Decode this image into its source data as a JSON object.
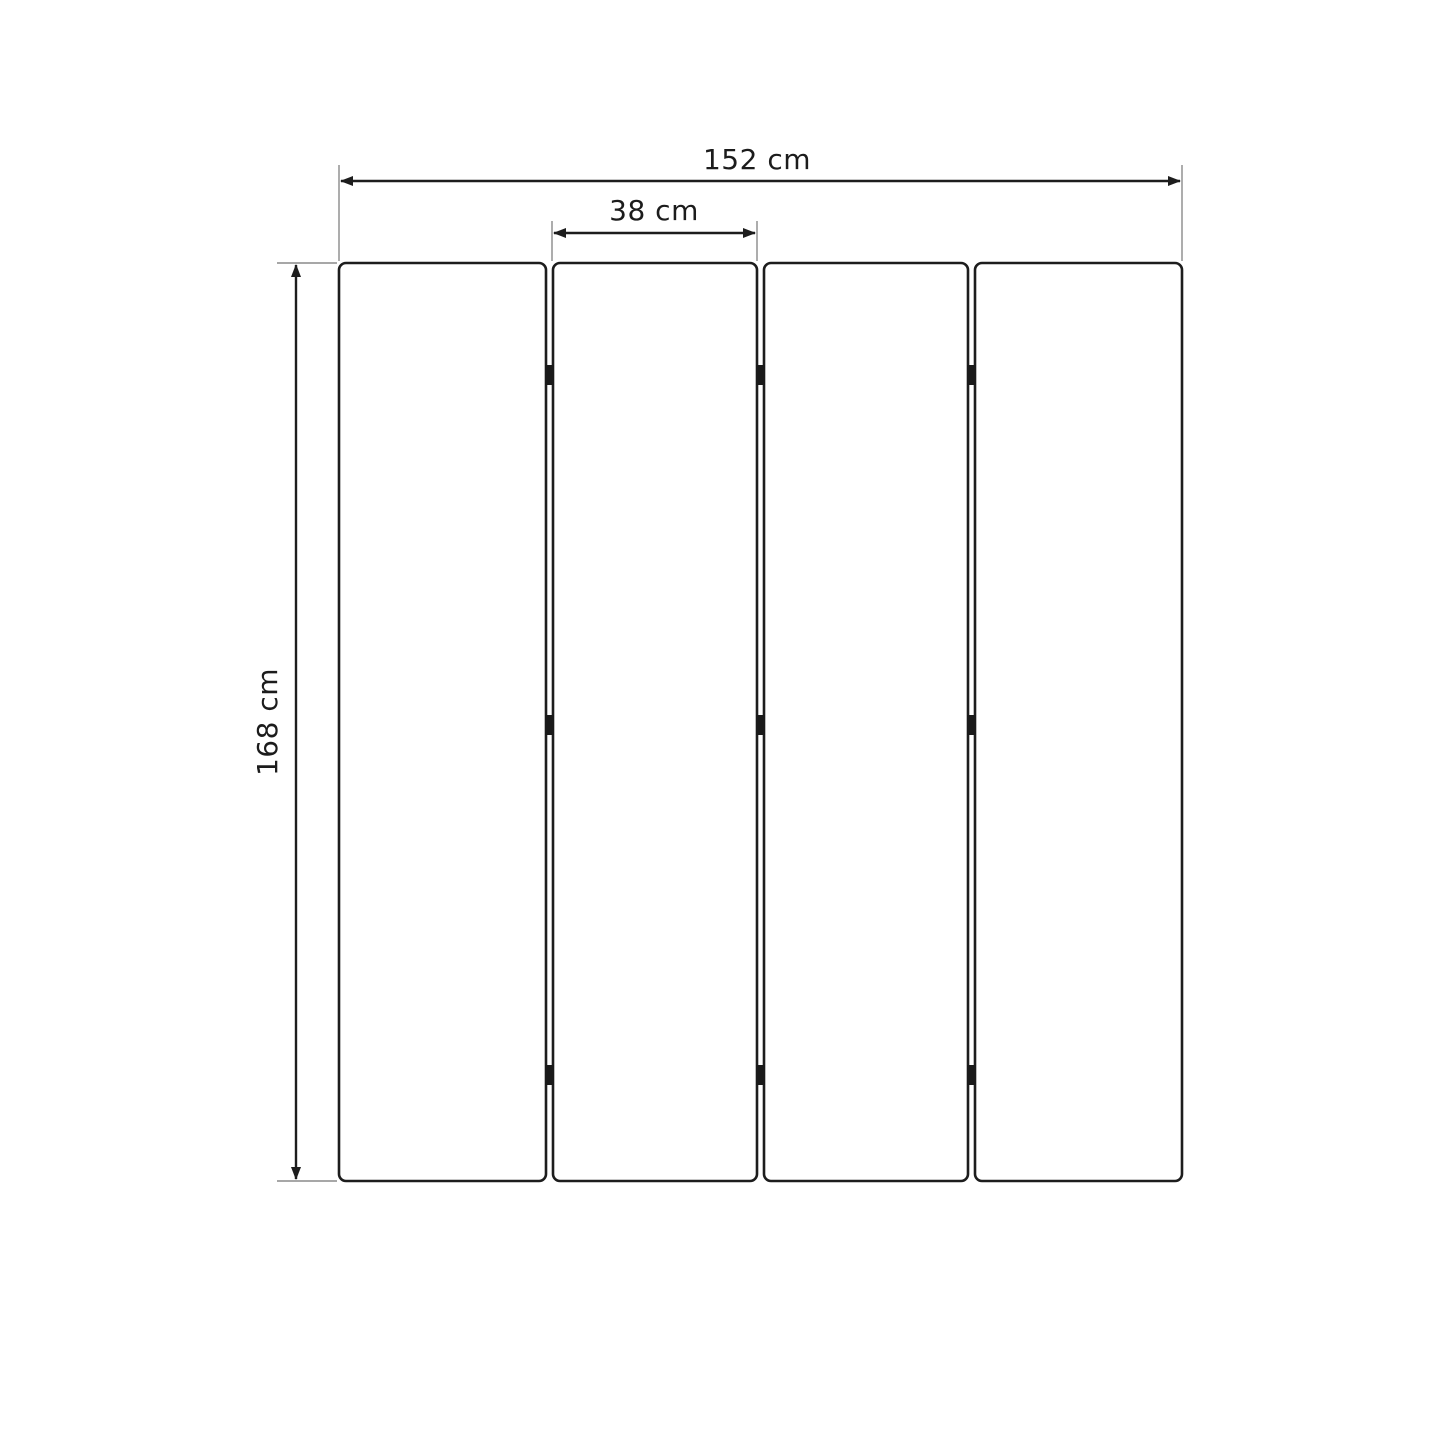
{
  "diagram": {
    "type": "technical-dimension-drawing",
    "subject": "four-panel folding screen front view",
    "panel_count": 4,
    "hinge_rows": 3,
    "dimensions": {
      "total_width": {
        "label": "152 cm",
        "value": 152,
        "unit": "cm"
      },
      "panel_width": {
        "label": "38 cm",
        "value": 38,
        "unit": "cm"
      },
      "height": {
        "label": "168 cm",
        "value": 168,
        "unit": "cm"
      }
    },
    "colors": {
      "background": "#ffffff",
      "panel_fill": "#ffffff",
      "outline": "#1d1d1d",
      "extension_line": "#8a8a8a",
      "hinge": "#1a1a1a",
      "label_text": "#1c1c1c"
    }
  }
}
